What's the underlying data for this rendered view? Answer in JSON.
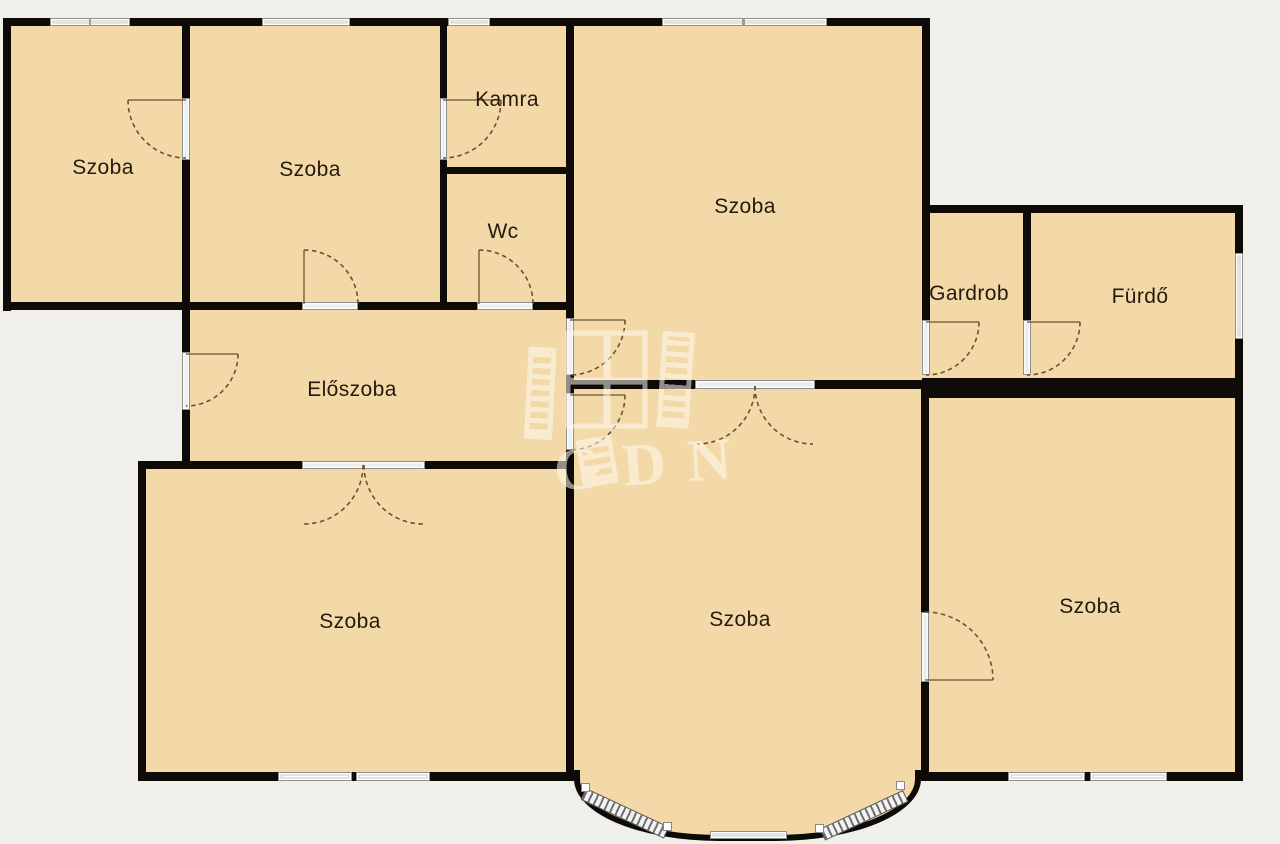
{
  "floorplan": {
    "title": "apartment floor plan",
    "background_color": "#f1efea",
    "floor_color": "#f3d9a7",
    "wall_color": "#0d0a07",
    "rooms": [
      {
        "id": "szoba-top-left",
        "label": "Szoba"
      },
      {
        "id": "szoba-top-middle",
        "label": "Szoba"
      },
      {
        "id": "kamra",
        "label": "Kamra"
      },
      {
        "id": "wc",
        "label": "Wc"
      },
      {
        "id": "szoba-top-right",
        "label": "Szoba"
      },
      {
        "id": "gardrob",
        "label": "Gardrob"
      },
      {
        "id": "furdo",
        "label": "Fürdő"
      },
      {
        "id": "eloszoba",
        "label": "Előszoba"
      },
      {
        "id": "szoba-bottom-left",
        "label": "Szoba"
      },
      {
        "id": "szoba-bottom-middle",
        "label": "Szoba"
      },
      {
        "id": "szoba-bottom-right",
        "label": "Szoba"
      }
    ],
    "watermark": {
      "text": "GDN"
    }
  }
}
